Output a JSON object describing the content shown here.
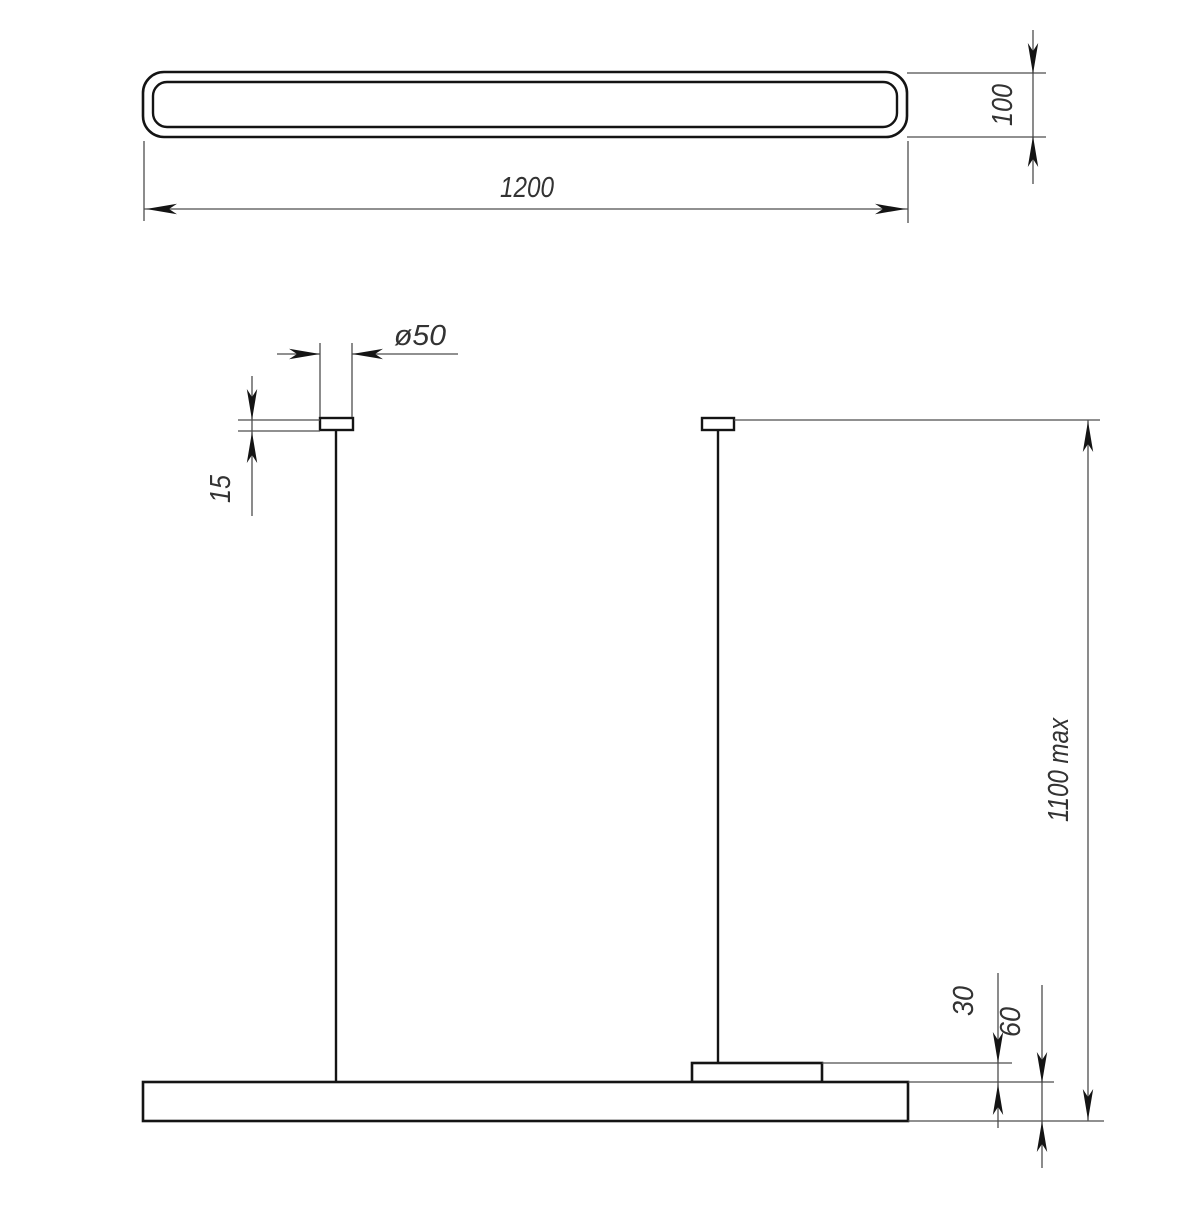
{
  "colors": {
    "outline": "#141414",
    "thin_line": "#4d4d4d",
    "text": "#333333",
    "background": "#ffffff"
  },
  "dimensions": {
    "length": "1200",
    "depth": "100",
    "canopy_diameter": "ø50",
    "canopy_height": "15",
    "suspension_max": "1100 max",
    "bracket_height": "30",
    "body_height": "60"
  }
}
